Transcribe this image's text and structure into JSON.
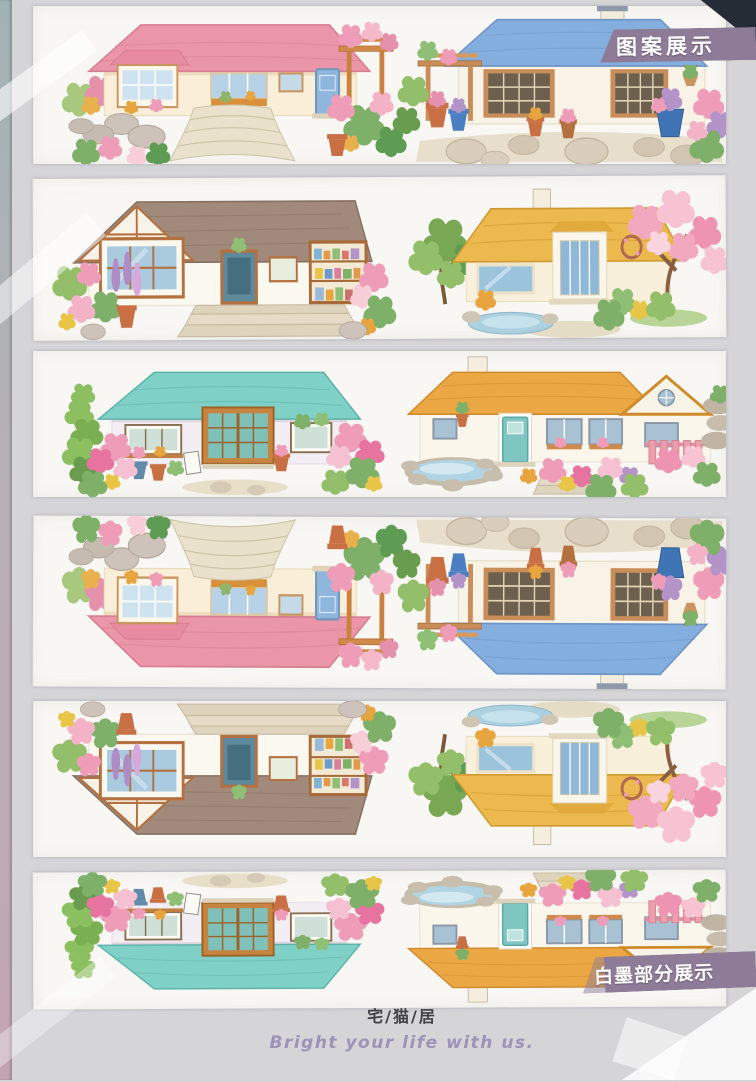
{
  "page": {
    "title_badge": "图案展示",
    "bottom_badge": "白墨部分展示",
    "footer": {
      "brand": "宅/猫/居",
      "slogan": "Bright your life with us."
    }
  },
  "palette": {
    "page_bg": "#d5d4d7",
    "strip_bg": "#f8f7f4",
    "badge_bg": "#8d7b97",
    "badge_text": "#ffffff",
    "corner_triangle": "#262c36",
    "edge_top": "#a2b3b5",
    "edge_bottom": "#c3a5b1",
    "brand_text": "#414046",
    "slogan_text": "#9b93b8",
    "roof_pink": "#eb96a8",
    "roof_blue": "#84aedd",
    "roof_brown": "#a18a7b",
    "roof_yellow": "#ecb94e",
    "roof_teal": "#7fd0c7",
    "roof_orange": "#eba743"
  },
  "strips": [
    {
      "name": "tape-strip-1",
      "orientation": "upright",
      "scenes": [
        "pink-roof-cottage-with-fan-stone-steps-and-pergola",
        "blue-roof-house-with-wood-pergola-and-stone-patio"
      ]
    },
    {
      "name": "tape-strip-2",
      "orientation": "upright",
      "scenes": [
        "brown-roof-garden-shop-house-with-wide-steps",
        "yellow-tile-roof-house-with-pink-blossom-tree-and-pond"
      ]
    },
    {
      "name": "tape-strip-3",
      "orientation": "upright",
      "scenes": [
        "teal-roof-wooden-storefront-with-flower-bushes",
        "orange-roof-house-with-pink-fence-and-round-pond"
      ]
    },
    {
      "name": "tape-strip-4",
      "orientation": "flipped",
      "scenes": [
        "pink-roof-cottage-with-fan-stone-steps-and-pergola",
        "blue-roof-house-with-wood-pergola-and-stone-patio"
      ]
    },
    {
      "name": "tape-strip-5",
      "orientation": "flipped",
      "scenes": [
        "brown-roof-garden-shop-house-with-wide-steps",
        "yellow-tile-roof-house-with-pink-blossom-tree-and-pond"
      ]
    },
    {
      "name": "tape-strip-6",
      "orientation": "flipped",
      "scenes": [
        "teal-roof-wooden-storefront-with-flower-bushes",
        "orange-roof-house-with-pink-fence-and-round-pond"
      ]
    }
  ]
}
